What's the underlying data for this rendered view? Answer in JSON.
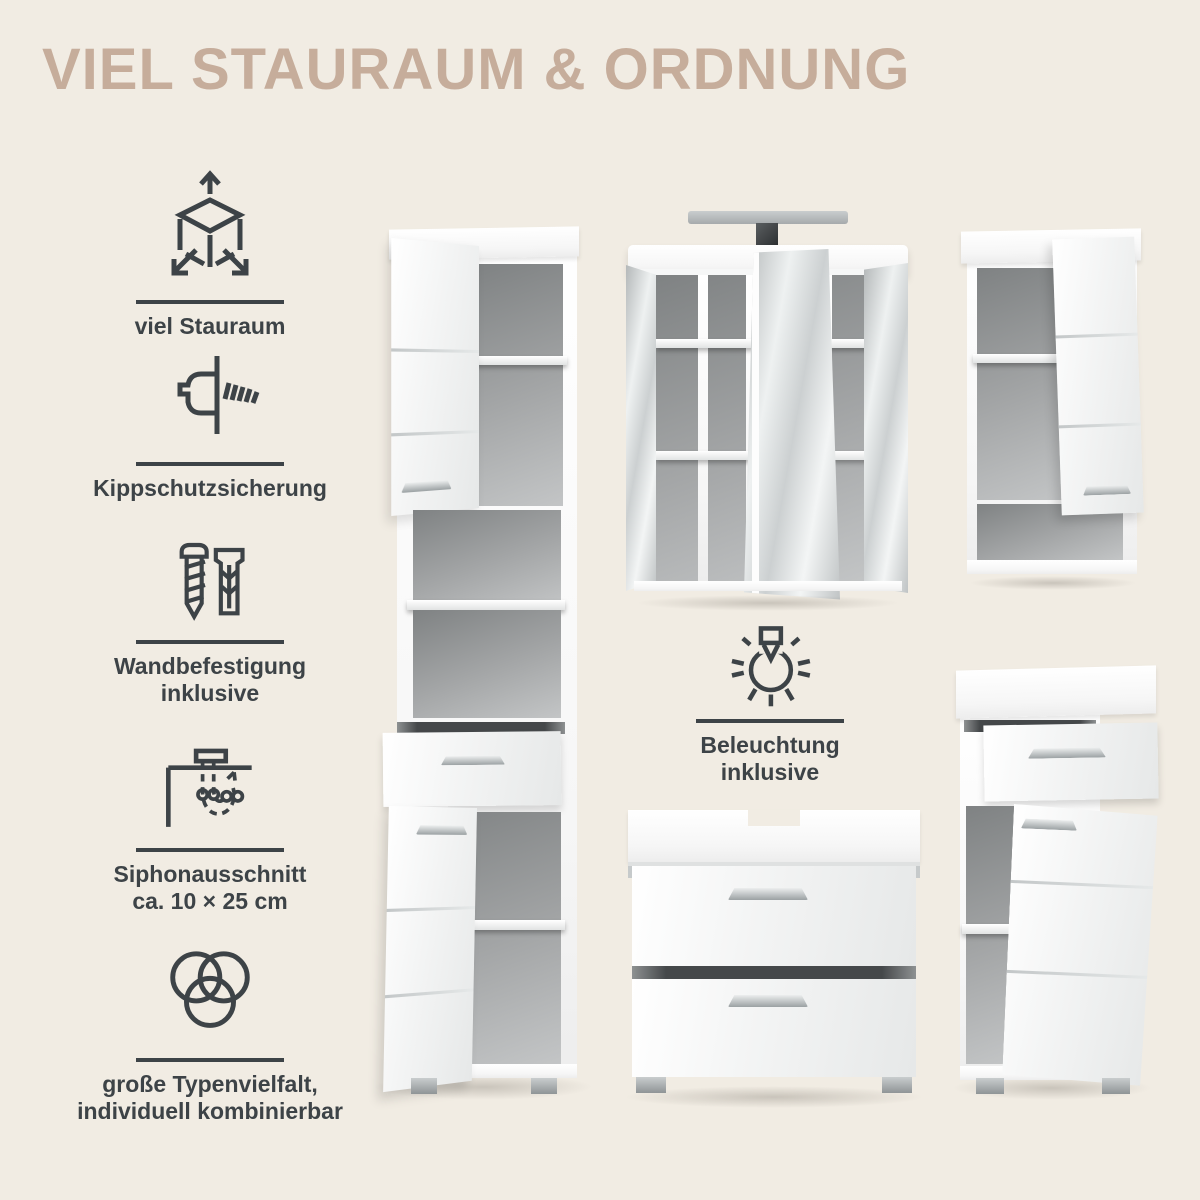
{
  "page": {
    "title": "VIEL STAURAUM & ORDNUNG"
  },
  "colors": {
    "background": "#f1ece3",
    "title": "#c6ad9b",
    "ink": "#3d4347",
    "cabinet_white": "#fbfbfb",
    "interior_gray": "#9a9c9d",
    "mirror_silver": "#d5d9da",
    "handle_silver": "#c2c7c9",
    "light_bar_gray": "#b4b8ba"
  },
  "features": [
    {
      "icon": "cube-dimensions-icon",
      "line1": "viel Stauraum",
      "line2": ""
    },
    {
      "icon": "anti-tip-screw-icon",
      "line1": "Kippschutzsicherung",
      "line2": ""
    },
    {
      "icon": "screw-and-dowel-icon",
      "line1": "Wandbefestigung",
      "line2": "inklusive"
    },
    {
      "icon": "siphon-cutout-icon",
      "line1": "Siphonausschnitt",
      "line2": "ca. 10 × 25 cm"
    },
    {
      "icon": "variety-circles-icon",
      "line1": "große Typenvielfalt,",
      "line2": "individuell kombinierbar"
    }
  ],
  "center_feature": {
    "icon": "light-bulb-icon",
    "line1": "Beleuchtung",
    "line2": "inklusive"
  }
}
